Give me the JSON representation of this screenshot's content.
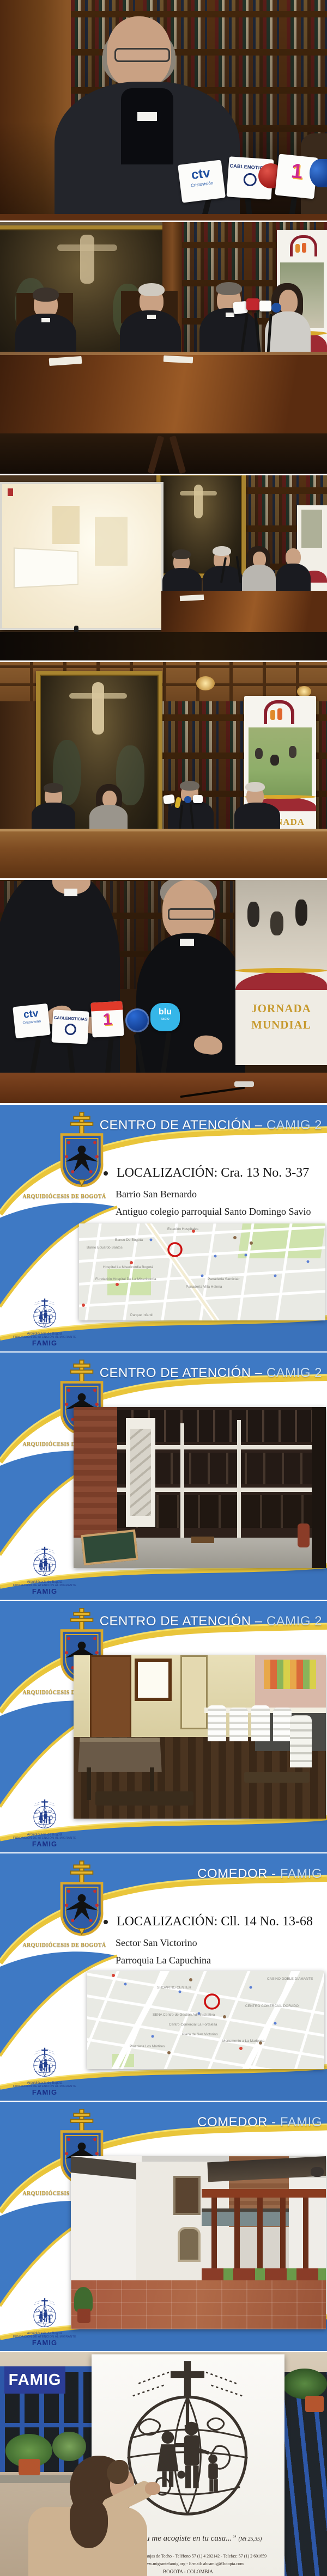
{
  "photo1": {
    "mics": {
      "ctv_big": "ctv",
      "ctv_small": "Cristovisión",
      "cable": "CABLENOTICIAS",
      "canal1": "1"
    }
  },
  "photo5": {
    "mics": {
      "ctv_big": "ctv",
      "ctv_small": "Cristovisión",
      "cable": "CABLENOTICIAS",
      "canal1": "1",
      "blu": "blu",
      "blu2": "radio"
    }
  },
  "banner_jornada": {
    "line1": "JORNADA",
    "line2": "MUNDIAL"
  },
  "slide_common": {
    "crest_caption": "ARQUIDIÓCESIS DE BOGOTÁ",
    "famig": {
      "l1": "Arquidiócesis de Bogotá",
      "l2": "FUNDACIÓN DE ATENCIÓN AL MIGRANTE",
      "l3": "FAMIG"
    }
  },
  "slides": [
    {
      "title_main": "CENTRO DE ATENCIÓN –",
      "title_suffix": "CAMIG 2",
      "bullet": "LOCALIZACIÓN: Cra. 13 No. 3-37",
      "line1": "Barrio San Bernardo",
      "line2": "Antiguo colegio parroquial Santo Domingo Savio"
    },
    {
      "title_main": "CENTRO DE ATENCIÓN –",
      "title_suffix": "CAMIG 2"
    },
    {
      "title_main": "CENTRO DE ATENCIÓN –",
      "title_suffix": "CAMIG 2"
    },
    {
      "title_main": "COMEDOR -",
      "title_suffix": "FAMIG",
      "bullet": "LOCALIZACIÓN: Cll. 14 No. 13-68",
      "line1": "Sector San Victorino",
      "line2": "Parroquia La Capuchina"
    },
    {
      "title_main": "COMEDOR -",
      "title_suffix": "FAMIG"
    }
  ],
  "maps": {
    "map1": {
      "labels": [
        "Estación Hospitales",
        "Hospital La Misericordia Bogotá",
        "Fundación Hospital De La Misericordia",
        "Barrio Eduardo Santos",
        "Banco De Bogotá",
        "Panadería Villa Helena",
        "Parque Infantil",
        "Panadería Santiclair"
      ]
    },
    "map2": {
      "labels": [
        "SHOPPING CENTER",
        "SENA Centro de Gestión Administrativa",
        "CENTRO COMERCIAL DORADO",
        "Plaza de San Victorino",
        "Monumento a La Mariposa",
        "CASINO DOBLE DIAMANTE",
        "Plazoleta Los Mártires",
        "Centro Comercial La Fortaleza"
      ]
    }
  },
  "photo6": {
    "badge": "FAMIG",
    "quote": "grante y tu me acogiste en tu casa...”",
    "quote_ref": "(Mt 25,35)",
    "addr1": "lle 17 No. 68 - 75 Granjas de Techo - Teléfono 57 (1) 4 202142 - Telefax: 57 (1) 2 601659",
    "addr2": "Web: www.migrantefamig.org - E-mail: abcamig@3utopia.com",
    "addr3": "BOGOTA - COLOMBIA"
  }
}
